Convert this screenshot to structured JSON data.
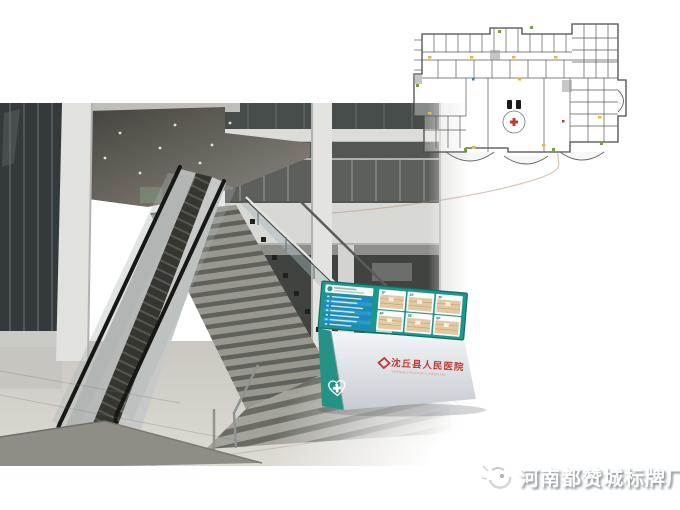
{
  "sign": {
    "board_color": "#1d968c",
    "directory_row_count": 7,
    "map_panels": [
      {
        "label": "1F"
      },
      {
        "label": "2F"
      },
      {
        "label": "3F"
      },
      {
        "label": "4F"
      },
      {
        "label": "5F"
      },
      {
        "label": "6F"
      }
    ],
    "hospital_name": "沈丘县人民医院",
    "hospital_name_en": "SHENQIU PEOPLE'S HOSPITAL"
  },
  "watermark": {
    "text": "河南都赞城标牌厂"
  },
  "colors": {
    "sign_teal": "#1d968c",
    "directory_blue": "#1f86c9",
    "hospital_red": "#c3392f",
    "plan_line": "#4a4a4a",
    "plan_accent_yellow": "#e2b94e",
    "plan_accent_green": "#76a23e"
  }
}
